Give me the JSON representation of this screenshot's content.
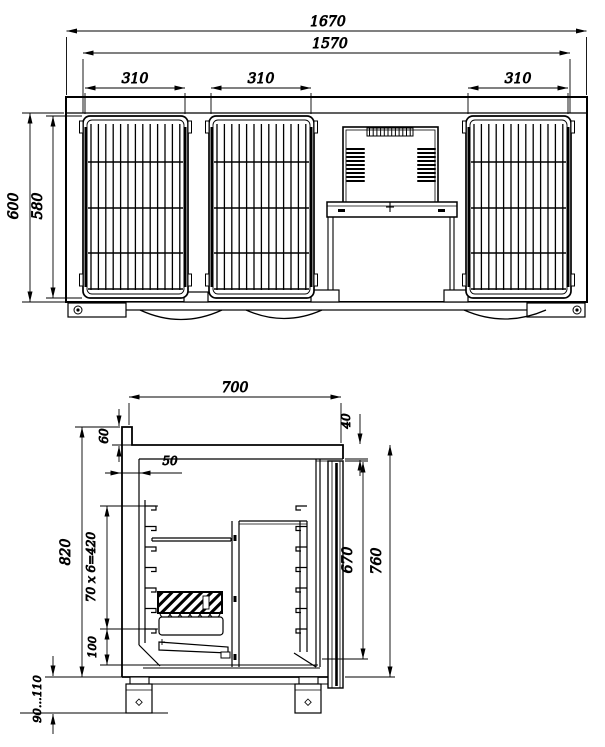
{
  "colors": {
    "background": "#ffffff",
    "line": "#000000"
  },
  "front_view": {
    "dims": {
      "overall_width": "1670",
      "inner_width": "1570",
      "door1_width": "310",
      "door2_width": "310",
      "door3_width": "310",
      "overall_height": "600",
      "door_height": "580"
    }
  },
  "section_view": {
    "dims": {
      "depth": "700",
      "rear_upstand_height": "60",
      "top_front_thickness": "40",
      "rear_wall_thickness": "50",
      "overall_height": "820",
      "shelf_bracket_pitch": "70 x 6=420",
      "bottom_clearance": "100",
      "door_opening_height": "670",
      "body_height": "760",
      "leg_height_range": "90...110"
    }
  }
}
